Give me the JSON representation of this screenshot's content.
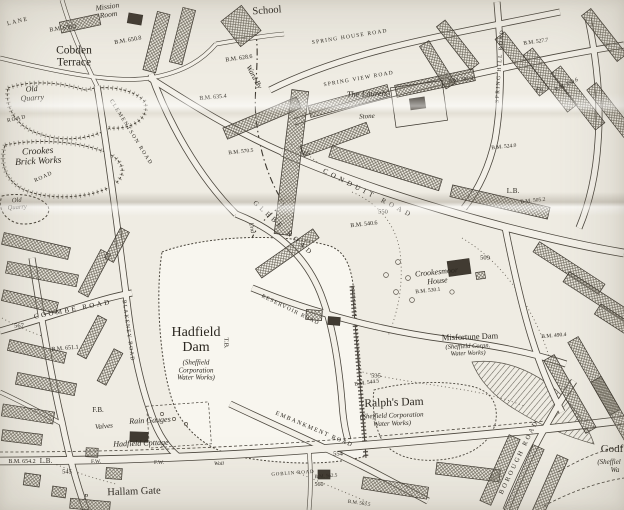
{
  "map": {
    "colors": {
      "paper": "#efece3",
      "ink": "#3a352e",
      "building_hatch": "#6f6a5e",
      "crease_shadow": "#6e6455"
    },
    "labels": [
      {
        "id": "lane-fragment",
        "text": "LANE",
        "x": 18,
        "y": 22,
        "rot": -14,
        "fs": 6,
        "ls": 1.5
      },
      {
        "id": "mission-room",
        "text": "Mission\nRoom",
        "x": 108,
        "y": 11,
        "rot": -8,
        "fs": 7.5,
        "it": true
      },
      {
        "id": "school",
        "text": "School",
        "x": 267,
        "y": 11,
        "rot": -4,
        "fs": 10.5
      },
      {
        "id": "bm-659-2",
        "text": "B.M. 659.2",
        "x": 63,
        "y": 29,
        "rot": -8,
        "fs": 6
      },
      {
        "id": "bm-650-8",
        "text": "B.M. 650.8",
        "x": 128,
        "y": 41,
        "rot": -10,
        "fs": 6
      },
      {
        "id": "cobden-terrace",
        "text": "Cobden\nTerrace",
        "x": 74,
        "y": 57,
        "fs": 11.5
      },
      {
        "id": "spring-house-road",
        "text": "SPRING HOUSE ROAD",
        "x": 350,
        "y": 38,
        "rot": -9,
        "fs": 5.5,
        "ls": 1.2
      },
      {
        "id": "spring-view-road",
        "text": "SPRING VIEW ROAD",
        "x": 359,
        "y": 80,
        "rot": -10,
        "fs": 5.5,
        "ls": 1.2
      },
      {
        "id": "the-laurels",
        "text": "The Laurels",
        "x": 367,
        "y": 94,
        "rot": -2,
        "fs": 8.5,
        "it": true
      },
      {
        "id": "stone",
        "text": "Stone",
        "x": 367,
        "y": 117,
        "rot": -3,
        "fs": 7,
        "it": true
      },
      {
        "id": "ward-by",
        "text": "Ward By",
        "x": 254,
        "y": 77,
        "rot": 62,
        "fs": 7.5,
        "it": true
      },
      {
        "id": "bm-628-6",
        "text": "B.M. 628.6",
        "x": 239,
        "y": 59,
        "rot": -8,
        "fs": 6
      },
      {
        "id": "bm-635-4",
        "text": "B.M. 635.4",
        "x": 213,
        "y": 98,
        "rot": -5,
        "fs": 6
      },
      {
        "id": "old-quarry-north",
        "text": "Old\nQuarry",
        "x": 32,
        "y": 94,
        "rot": -4,
        "fs": 8,
        "it": true
      },
      {
        "id": "crookes-brick-works",
        "text": "Crookes\nBrick Works",
        "x": 38,
        "y": 157,
        "rot": -3,
        "fs": 9.5,
        "it": true
      },
      {
        "id": "old-quarry-south",
        "text": "Old\nQuarry",
        "x": 17,
        "y": 204,
        "rot": -4,
        "fs": 6.5,
        "it": true
      },
      {
        "id": "road-fragment-1",
        "text": "ROAD",
        "x": 17,
        "y": 120,
        "rot": -12,
        "fs": 5.5,
        "ls": 1
      },
      {
        "id": "road-fragment-2",
        "text": "ROAD",
        "x": 44,
        "y": 178,
        "rot": -25,
        "fs": 5.5,
        "ls": 1
      },
      {
        "id": "clementson-road",
        "text": "CLEMENTSON ROAD",
        "x": 130,
        "y": 133,
        "rot": 58,
        "fs": 5.5,
        "ls": 1.5
      },
      {
        "id": "spring-hill-road",
        "text": "SPRING HILL ROAD",
        "x": 501,
        "y": 66,
        "rot": -86,
        "fs": 5.5,
        "ls": 1.5
      },
      {
        "id": "bm-527-7",
        "text": "B.M. 527.7",
        "x": 536,
        "y": 43,
        "rot": -8,
        "fs": 5.5
      },
      {
        "id": "bm-561-9",
        "text": "B.M. 561.9",
        "x": 461,
        "y": 81,
        "rot": -6,
        "fs": 5.5
      },
      {
        "id": "fn-mark",
        "text": "Fn.",
        "x": 540,
        "y": 90,
        "fs": 6.5,
        "it": true
      },
      {
        "id": "bm-550-6",
        "text": "B.M. 550.6",
        "x": 567,
        "y": 86,
        "rot": -25,
        "fs": 5.5
      },
      {
        "id": "conduit-road",
        "text": "CONDUIT ROAD",
        "x": 368,
        "y": 194,
        "rot": 27,
        "fs": 7,
        "ls": 4
      },
      {
        "id": "glebe-road",
        "text": "GLEBE ROAD",
        "x": 283,
        "y": 229,
        "rot": 42,
        "fs": 7,
        "ls": 3.5
      },
      {
        "id": "contour-605",
        "text": "605",
        "x": 305,
        "y": 154,
        "fs": 6.5
      },
      {
        "id": "contour-550",
        "text": "550",
        "x": 383,
        "y": 212,
        "fs": 6.5
      },
      {
        "id": "bm-540-6",
        "text": "B.M. 540.6",
        "x": 364,
        "y": 225,
        "rot": -6,
        "fs": 6
      },
      {
        "id": "bm-570-5",
        "text": "B.M. 570.5",
        "x": 241,
        "y": 153,
        "rot": -6,
        "fs": 5.5
      },
      {
        "id": "und-boundary",
        "text": "Und",
        "x": 251,
        "y": 228,
        "rot": 80,
        "fs": 6,
        "it": true
      },
      {
        "id": "bm-524-0",
        "text": "B.M. 524.0",
        "x": 504,
        "y": 148,
        "rot": -6,
        "fs": 5.5
      },
      {
        "id": "letter-box-east",
        "text": "L.B.",
        "x": 513,
        "y": 192,
        "fs": 7
      },
      {
        "id": "bm-505-2",
        "text": "B.M. 505.2",
        "x": 533,
        "y": 202,
        "rot": -6,
        "fs": 5.5
      },
      {
        "id": "contour-509",
        "text": "509",
        "x": 485,
        "y": 258,
        "fs": 6.5
      },
      {
        "id": "crookesmoor-house",
        "text": "Crookesmoor\nHouse",
        "x": 437,
        "y": 277,
        "rot": -6,
        "fs": 8,
        "it": true
      },
      {
        "id": "bm-530-1",
        "text": "B.M. 530.1",
        "x": 428,
        "y": 292,
        "rot": -6,
        "fs": 5.5
      },
      {
        "id": "misfortune-dam",
        "text": "Misfortune Dam",
        "x": 470,
        "y": 337,
        "rot": -2,
        "fs": 8.5
      },
      {
        "id": "misfortune-dam-sub",
        "text": "(Sheffield Corpn.\nWater Works)",
        "x": 468,
        "y": 350,
        "rot": -2,
        "fs": 6.5,
        "it": true
      },
      {
        "id": "hadfield-dam",
        "text": "Hadfield\nDam",
        "x": 196,
        "y": 340,
        "fs": 14
      },
      {
        "id": "hadfield-dam-sub",
        "text": "(Sheffield\nCorporation\nWater Works)",
        "x": 196,
        "y": 371,
        "fs": 7,
        "it": true
      },
      {
        "id": "tb-mark",
        "text": "T.B.",
        "x": 226,
        "y": 343,
        "rot": 90,
        "fs": 6.5
      },
      {
        "id": "reservoir-road",
        "text": "RESERVOIR ROAD",
        "x": 290,
        "y": 311,
        "rot": 26,
        "fs": 5.5,
        "ls": 1.2
      },
      {
        "id": "ralphs-dam",
        "text": "Ralph's Dam",
        "x": 394,
        "y": 403,
        "rot": -2,
        "fs": 11.5
      },
      {
        "id": "ralphs-dam-sub",
        "text": "(Sheffield Corporation\nWater Works)",
        "x": 392,
        "y": 420,
        "rot": -2,
        "fs": 7,
        "it": true
      },
      {
        "id": "contour-535",
        "text": "535",
        "x": 376,
        "y": 376,
        "fs": 6.5
      },
      {
        "id": "bm-544-5",
        "text": "B.M. 544.5",
        "x": 367,
        "y": 384,
        "rot": -8,
        "fs": 5.5
      },
      {
        "id": "embankment-road",
        "text": "EMBANKMENT ROAD",
        "x": 314,
        "y": 430,
        "rot": 23,
        "fs": 6,
        "ls": 1.5
      },
      {
        "id": "contour-554",
        "text": "554",
        "x": 338,
        "y": 454,
        "fs": 6.5
      },
      {
        "id": "goblin-road",
        "text": "GOBLIN ROAD",
        "x": 293,
        "y": 474,
        "rot": -4,
        "fs": 5,
        "ls": 0.8
      },
      {
        "id": "bm-562-5",
        "text": "B.M. 562.5",
        "x": 326,
        "y": 477,
        "rot": -4,
        "fs": 5
      },
      {
        "id": "contour-560",
        "text": "560",
        "x": 319,
        "y": 485,
        "fs": 6
      },
      {
        "id": "bm-563-5",
        "text": "B.M. 563.5",
        "x": 359,
        "y": 504,
        "rot": 8,
        "fs": 5
      },
      {
        "id": "rain-gauges",
        "text": "Rain Gauges",
        "x": 150,
        "y": 421,
        "rot": -3,
        "fs": 8,
        "it": true
      },
      {
        "id": "fb-mark",
        "text": "F.B.",
        "x": 98,
        "y": 411,
        "fs": 7
      },
      {
        "id": "valves",
        "text": "Valves",
        "x": 104,
        "y": 427,
        "rot": -5,
        "fs": 7,
        "it": true
      },
      {
        "id": "hadfield-cottage",
        "text": "Hadfield Cottage",
        "x": 141,
        "y": 444,
        "rot": -2,
        "fs": 8,
        "it": true
      },
      {
        "id": "fw-mark-1",
        "text": "F.W.",
        "x": 96,
        "y": 463,
        "fs": 5.5
      },
      {
        "id": "fw-mark-2",
        "text": "F.W.",
        "x": 159,
        "y": 464,
        "fs": 5.5
      },
      {
        "id": "wall-mark",
        "text": "Wall",
        "x": 219,
        "y": 465,
        "fs": 5.5,
        "it": true
      },
      {
        "id": "hallam-gate",
        "text": "Hallam Gate",
        "x": 134,
        "y": 492,
        "rot": -2,
        "fs": 10.5
      },
      {
        "id": "bm-654-2",
        "text": "B.M. 654.2",
        "x": 22,
        "y": 462,
        "fs": 6
      },
      {
        "id": "letter-box-west",
        "text": "L.B.",
        "x": 46,
        "y": 462,
        "fs": 7
      },
      {
        "id": "contour-545",
        "text": "545",
        "x": 67,
        "y": 472,
        "fs": 6.5
      },
      {
        "id": "p-mark",
        "text": "P",
        "x": 86,
        "y": 498,
        "fs": 7,
        "it": true
      },
      {
        "id": "coombe-road",
        "text": "COOMBE ROAD",
        "x": 73,
        "y": 310,
        "rot": -11,
        "fs": 7,
        "ls": 2.5
      },
      {
        "id": "contour-567",
        "text": "567",
        "x": 19,
        "y": 326,
        "fs": 6.5
      },
      {
        "id": "bm-651-1",
        "text": "B.M. 651.1",
        "x": 65,
        "y": 349,
        "rot": -5,
        "fs": 6
      },
      {
        "id": "blakeney-road",
        "text": "BLAKENEY ROAD",
        "x": 127,
        "y": 331,
        "rot": 82,
        "fs": 5.5,
        "ls": 1.2
      },
      {
        "id": "borough-road",
        "text": "BOROUGH ROAD",
        "x": 519,
        "y": 457,
        "rot": -64,
        "fs": 6.5,
        "ls": 2.5
      },
      {
        "id": "godfrey-dam-partial",
        "text": "Godf",
        "x": 612,
        "y": 450,
        "fs": 11
      },
      {
        "id": "godfrey-dam-sub-1",
        "text": "(Sheffiel",
        "x": 609,
        "y": 463,
        "fs": 7,
        "it": true
      },
      {
        "id": "godfrey-dam-sub-2",
        "text": "Wa",
        "x": 615,
        "y": 471,
        "fs": 7,
        "it": true
      },
      {
        "id": "bm-490-4",
        "text": "B.M. 490.4",
        "x": 554,
        "y": 337,
        "rot": -5,
        "fs": 5.5
      }
    ]
  }
}
